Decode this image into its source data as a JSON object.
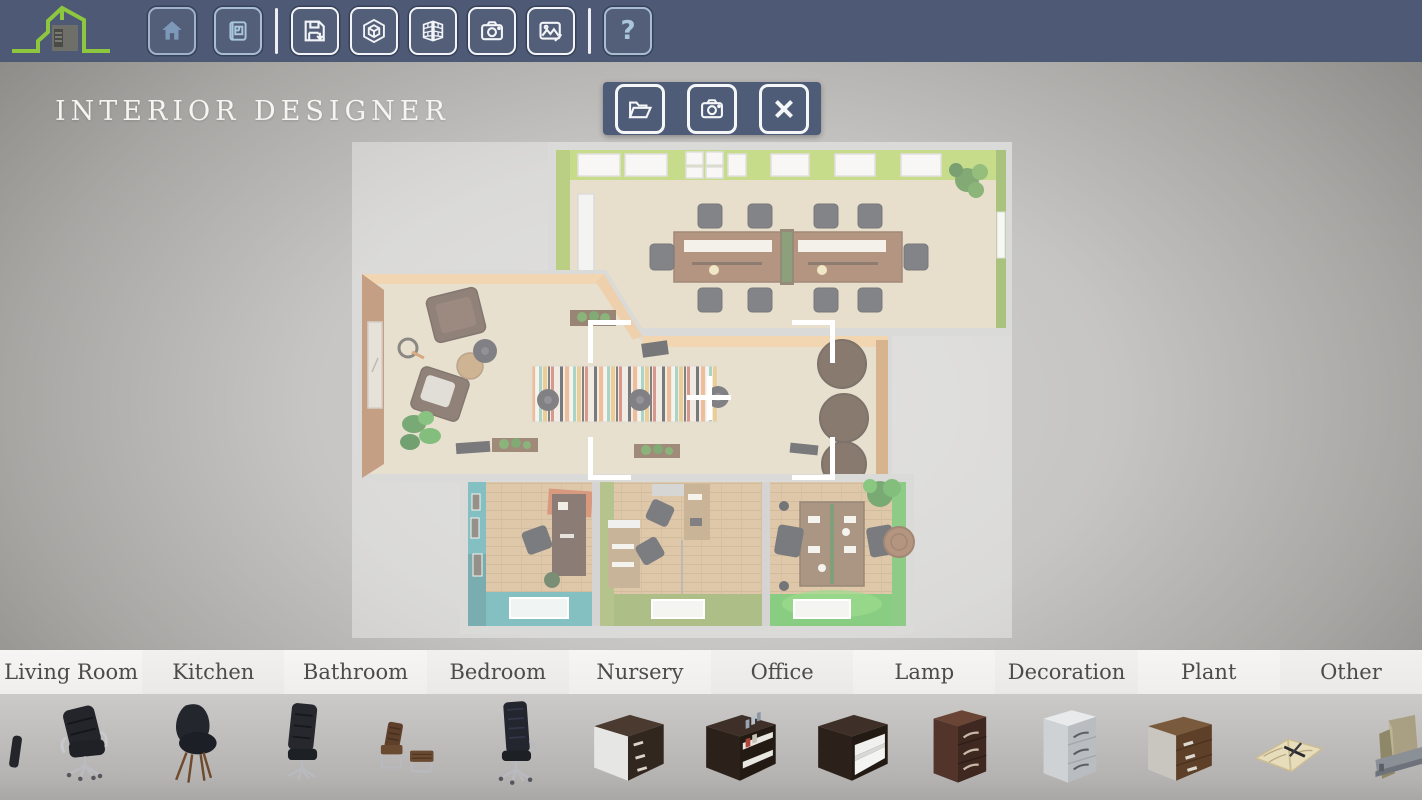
{
  "app": {
    "title": "INTERIOR DESIGNER"
  },
  "topbar": {
    "help_label": "?",
    "buttons": [
      {
        "name": "home",
        "icon": "home-icon",
        "state": "muted"
      },
      {
        "name": "floorplan-view",
        "icon": "blueprint-icon",
        "state": "muted"
      },
      {
        "name": "save",
        "icon": "save-icon",
        "state": "normal"
      },
      {
        "name": "view-3d",
        "icon": "cube-3d-icon",
        "state": "normal"
      },
      {
        "name": "walls",
        "icon": "brick-wall-icon",
        "state": "normal"
      },
      {
        "name": "camera",
        "icon": "camera-icon",
        "state": "normal"
      },
      {
        "name": "snapshot-edit",
        "icon": "image-edit-icon",
        "state": "normal"
      },
      {
        "name": "help",
        "icon": "question-icon",
        "state": "muted"
      }
    ]
  },
  "overlay_toolbar": {
    "buttons": [
      {
        "name": "open-project",
        "icon": "open-folder-icon"
      },
      {
        "name": "screenshot",
        "icon": "camera-icon"
      },
      {
        "name": "close",
        "icon": "close-icon"
      }
    ]
  },
  "scene": {
    "description": "top-down 3d office floorplan",
    "selection": {
      "crosshair": true,
      "corner_brackets": 4
    }
  },
  "categories": {
    "items": [
      "Living Room",
      "Kitchen",
      "Bathroom",
      "Bedroom",
      "Nursery",
      "Office",
      "Lamp",
      "Decoration",
      "Plant",
      "Other"
    ]
  },
  "library": {
    "items": [
      {
        "icon": "partial-chair-icon"
      },
      {
        "icon": "office-armchair-icon"
      },
      {
        "icon": "shell-chair-icon"
      },
      {
        "icon": "desk-chair-icon"
      },
      {
        "icon": "lounge-chair-ottoman-icon"
      },
      {
        "icon": "highback-office-chair-icon"
      },
      {
        "icon": "drawer-cube-white-icon"
      },
      {
        "icon": "shelf-cube-books-icon"
      },
      {
        "icon": "open-shelf-cube-icon"
      },
      {
        "icon": "drawer-unit-dark-icon"
      },
      {
        "icon": "drawer-unit-white-icon"
      },
      {
        "icon": "drawer-unit-brown-icon"
      },
      {
        "icon": "notebook-pen-icon"
      },
      {
        "icon": "file-folders-icon"
      }
    ]
  },
  "colors": {
    "topbar": "#4e5a75",
    "accent_green": "#8dc63f",
    "lime_wall": "#a7c94a",
    "green_wall": "#79a036",
    "teal_wall": "#3f9d9e",
    "olive_wall": "#8ba24c",
    "bright_green_wall": "#4cb140",
    "wood_floor": "#d9cbb0",
    "category_bar": "#f3f2f0",
    "strip": "#c0bebc"
  }
}
